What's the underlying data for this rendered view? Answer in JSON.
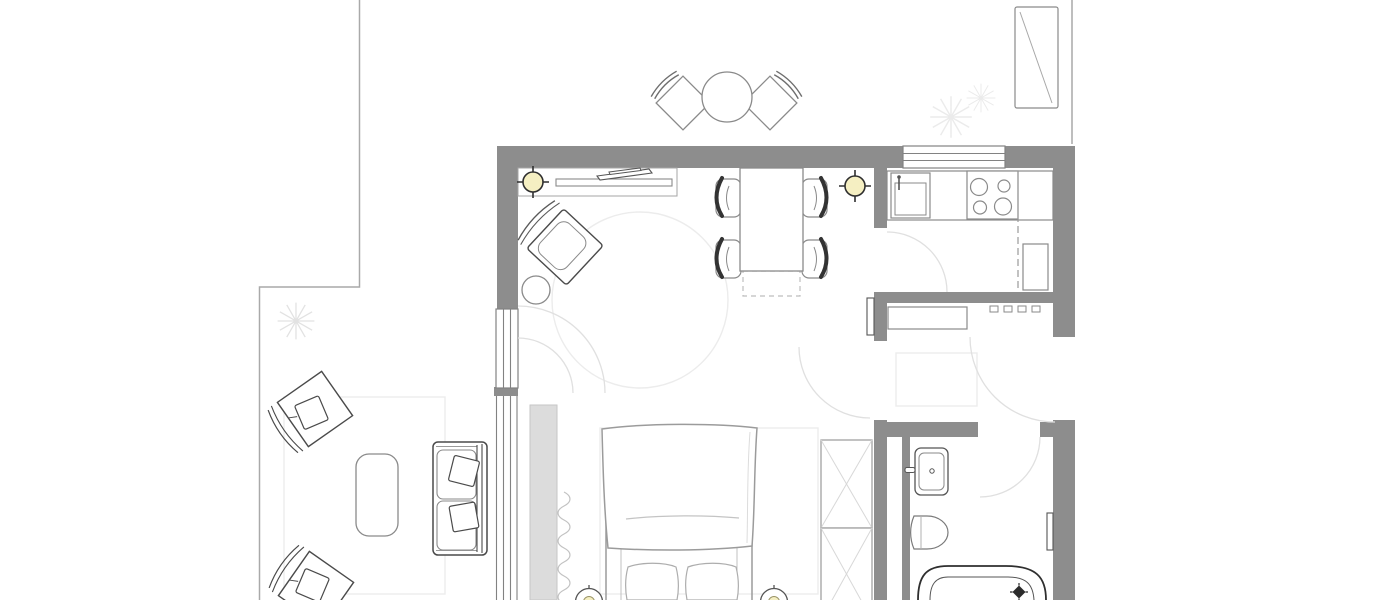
{
  "meta": {
    "type": "floor-plan",
    "canvas_width": 1400,
    "canvas_height": 600
  },
  "palette": {
    "background": "#ffffff",
    "wall": "#8d8d8d",
    "outline_dark": "#4a4a4a",
    "outline_mid": "#8a8a8a",
    "faint": "#e0e0e0",
    "rug_line": "#ececec",
    "cabinet_fill": "#dcdcdc",
    "lamp_fill": "#f5efc2",
    "drain_fill": "#2b2b2b"
  },
  "rooms": [
    {
      "name": "living-dining-room",
      "furniture": [
        "wall-shelf-with-tv",
        "ceiling-lamp-left",
        "ceiling-lamp-right",
        "armchair",
        "pouf",
        "round-rug",
        "dining-table",
        "dining-table-extension",
        "dining-chair-1",
        "dining-chair-2",
        "dining-chair-3",
        "dining-chair-4"
      ]
    },
    {
      "name": "sleeping-area",
      "furniture": [
        "double-bed",
        "duvet",
        "pillow-1",
        "pillow-2",
        "bedside-lamp-left",
        "bedside-lamp-right",
        "built-in-wardrobe",
        "closet-with-x-1",
        "closet-with-x-2",
        "curtain",
        "bed-rug"
      ]
    },
    {
      "name": "kitchen",
      "furniture": [
        "counter",
        "kitchen-sink",
        "cooktop-4-burners",
        "base-cabinet",
        "counter-dashed-line"
      ]
    },
    {
      "name": "hallway",
      "furniture": [
        "shoe-bench",
        "wall-hooks",
        "hall-rug",
        "entry-door-swing"
      ]
    },
    {
      "name": "bathroom",
      "furniture": [
        "washbasin",
        "toilet",
        "bathtub",
        "floor-drain",
        "wall-niche"
      ]
    },
    {
      "name": "patio",
      "furniture": [
        "lounge-chair-1",
        "lounge-chair-2",
        "coffee-table",
        "outdoor-sofa",
        "outdoor-rug",
        "plant"
      ]
    },
    {
      "name": "terrace",
      "furniture": [
        "bistro-table",
        "bistro-chair-left",
        "bistro-chair-right",
        "sun-lounger",
        "plant-1",
        "plant-2"
      ]
    }
  ],
  "openings": [
    "top-window",
    "left-window",
    "glass-sliding-door",
    "kitchen-door",
    "hallway-door",
    "entry-door",
    "bathroom-door"
  ]
}
